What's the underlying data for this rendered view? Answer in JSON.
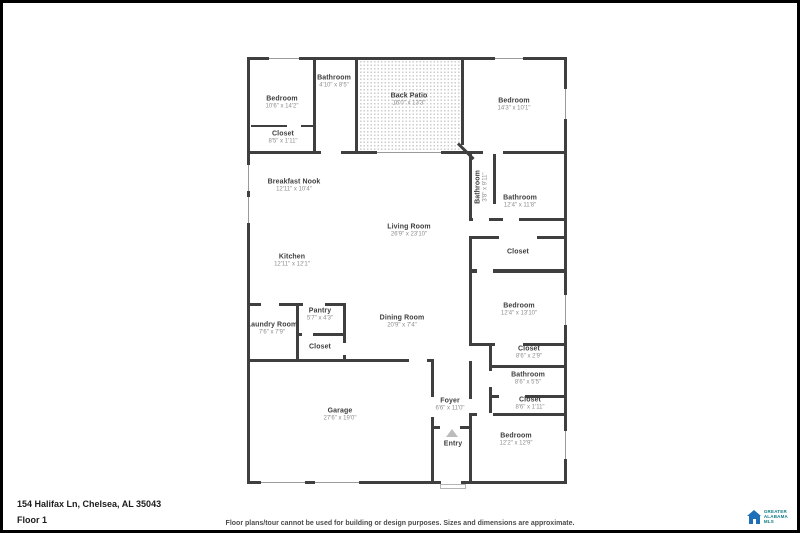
{
  "rooms": {
    "bedroom_tl": {
      "name": "Bedroom",
      "dims": "10'6\" x 14'2\""
    },
    "bathroom_tl": {
      "name": "Bathroom",
      "dims": "4'10\" x 8'5\""
    },
    "closet_tl": {
      "name": "Closet",
      "dims": "8'5\" x 1'11\""
    },
    "back_patio": {
      "name": "Back Patio",
      "dims": "16'0\" x 13'3\""
    },
    "bedroom_tr": {
      "name": "Bedroom",
      "dims": "14'3\" x 10'1\""
    },
    "bathroom_small": {
      "name": "Bathroom",
      "dims": "3'8\" x 9'11\""
    },
    "bathroom_r": {
      "name": "Bathroom",
      "dims": "12'4\" x 11'8\""
    },
    "closet_r": {
      "name": "Closet",
      "dims": ""
    },
    "bedroom_r": {
      "name": "Bedroom",
      "dims": "12'4\" x 13'10\""
    },
    "breakfast_nook": {
      "name": "Breakfast Nook",
      "dims": "12'11\" x 10'4\""
    },
    "living_room": {
      "name": "Living Room",
      "dims": "26'9\" x 23'10\""
    },
    "kitchen": {
      "name": "Kitchen",
      "dims": "12'11\" x 12'1\""
    },
    "laundry": {
      "name": "Laundry Room",
      "dims": "7'6\" x 7'9\""
    },
    "pantry": {
      "name": "Pantry",
      "dims": "5'7\" x 4'3\""
    },
    "closet_pantry": {
      "name": "Closet",
      "dims": ""
    },
    "dining": {
      "name": "Dining Room",
      "dims": "20'9\" x 7'4\""
    },
    "closet_b1": {
      "name": "Closet",
      "dims": "8'6\" x 2'9\""
    },
    "bathroom_b": {
      "name": "Bathroom",
      "dims": "8'6\" x 5'5\""
    },
    "closet_b2": {
      "name": "Closet",
      "dims": "8'6\" x 1'11\""
    },
    "garage": {
      "name": "Garage",
      "dims": "27'6\" x 19'0\""
    },
    "foyer": {
      "name": "Foyer",
      "dims": "6'6\" x 11'0\""
    },
    "entry": {
      "name": "Entry",
      "dims": ""
    },
    "bedroom_br": {
      "name": "Bedroom",
      "dims": "12'2\" x 12'9\""
    }
  },
  "footer": {
    "address": "154 Halifax Ln, Chelsea, AL 35043",
    "floor_label": "Floor 1",
    "disclaimer": "Floor plans/tour cannot be used for building or design purposes. Sizes and dimensions are approximate."
  },
  "logo": {
    "name": "Greater Alabama MLS",
    "line1": "GREATER",
    "line2": "ALABAMA",
    "line3": "MLS"
  },
  "colors": {
    "wall": "#3f3f3f",
    "room_name": "#3e3e3e",
    "room_dims": "#8d8d8d",
    "logo_blue": "#1d6fb8",
    "logo_teal": "#0e7b84"
  }
}
